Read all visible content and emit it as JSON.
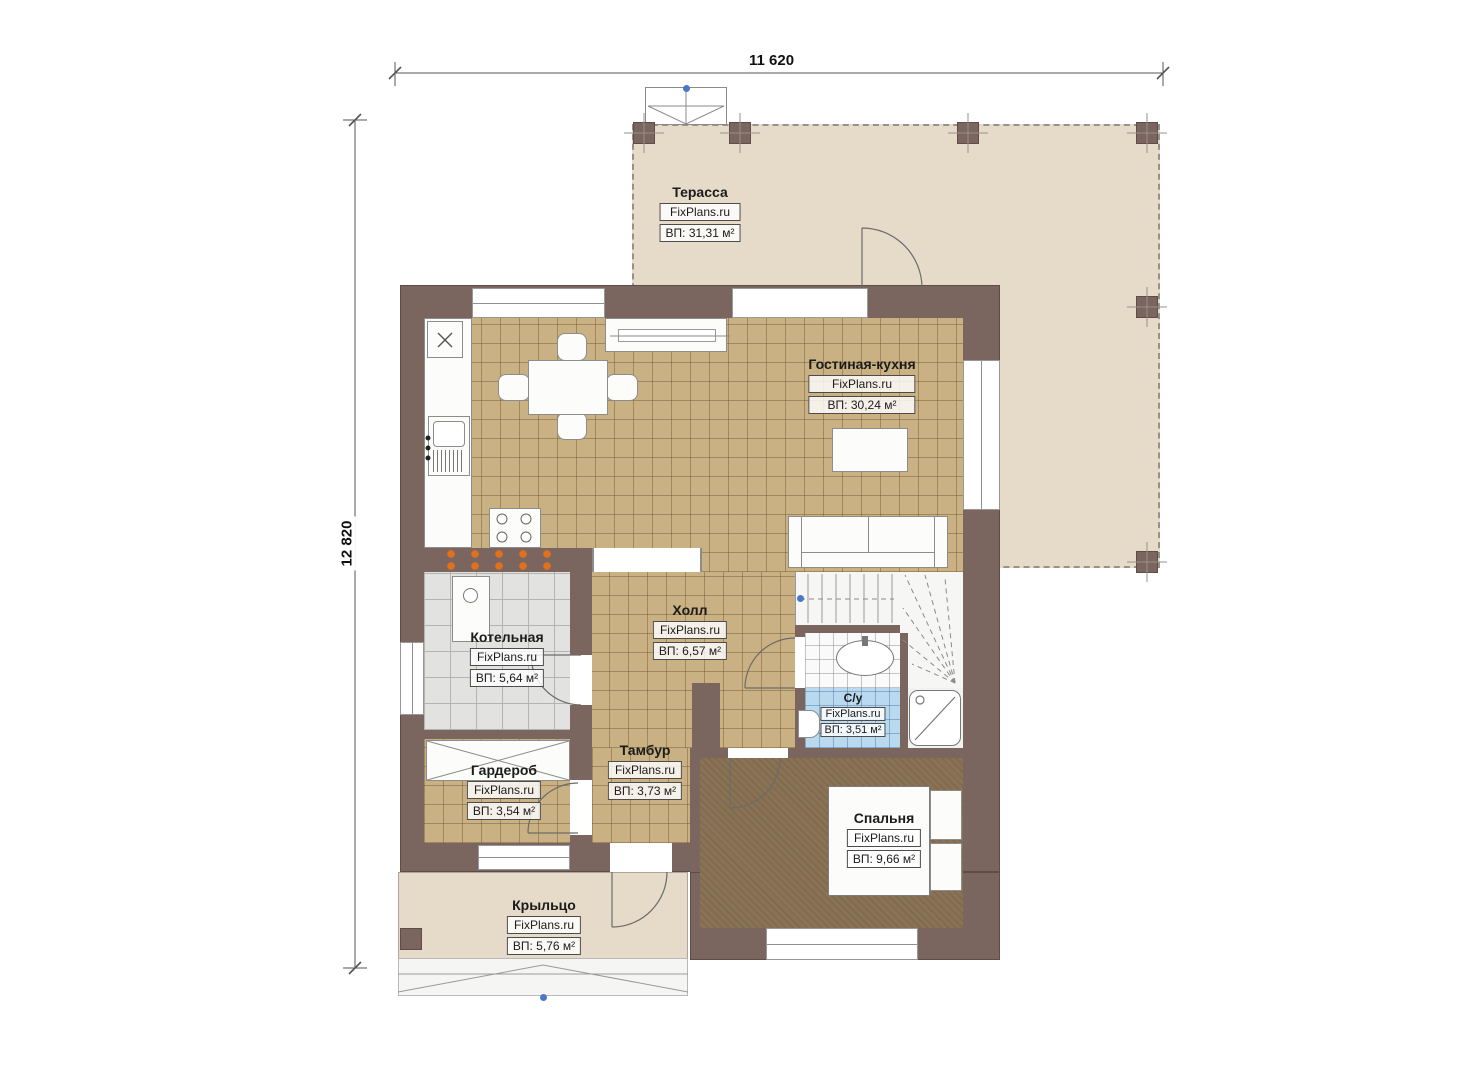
{
  "title": "План первого этажа",
  "brand": "FixPlans.ru",
  "dimensions": {
    "width_label": "11 620",
    "height_label": "12 820"
  },
  "rooms": [
    {
      "name": "Терасса",
      "brand": "FixPlans.ru",
      "area": "ВП: 31,31 м²"
    },
    {
      "name": "Гостиная-кухня",
      "brand": "FixPlans.ru",
      "area": "ВП: 30,24 м²"
    },
    {
      "name": "Котельная",
      "brand": "FixPlans.ru",
      "area": "ВП: 5,64 м²"
    },
    {
      "name": "Холл",
      "brand": "FixPlans.ru",
      "area": "ВП: 6,57 м²"
    },
    {
      "name": "С/у",
      "brand": "FixPlans.ru",
      "area": "ВП: 3,51 м²"
    },
    {
      "name": "Гардероб",
      "brand": "FixPlans.ru",
      "area": "ВП: 3,54 м²"
    },
    {
      "name": "Тамбур",
      "brand": "FixPlans.ru",
      "area": "ВП: 3,73 м²"
    },
    {
      "name": "Спальня",
      "brand": "FixPlans.ru",
      "area": "ВП: 9,66 м²"
    },
    {
      "name": "Крыльцо",
      "brand": "FixPlans.ru",
      "area": "ВП: 5,76 м²"
    }
  ],
  "colors": {
    "wall": "#7a655f",
    "tan": "#c9b183",
    "terr": "#e5dbc8",
    "gray": "#e2e2e0",
    "blue": "#b9d9ef",
    "carpet": "#8a7355",
    "orange": "#e0701e",
    "dot": "#4a78c8"
  }
}
